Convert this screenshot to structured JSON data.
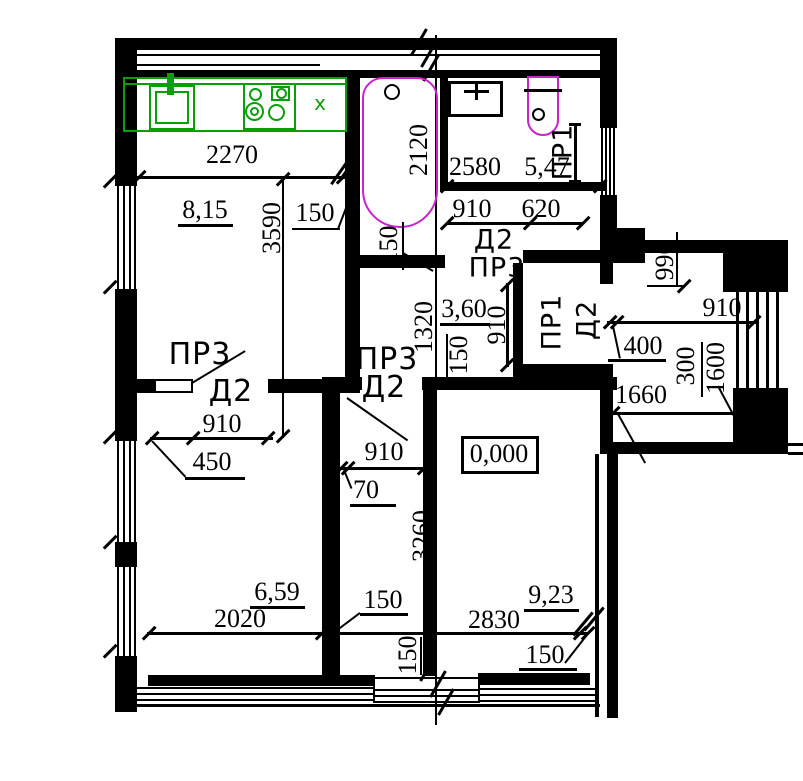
{
  "drawing": {
    "type": "apartment floor plan",
    "level_mark": "0,000"
  },
  "colors": {
    "walls": "#000000",
    "kitchen_fixtures": "#0a9e0a",
    "plumbing_fixtures": "#cc22cc"
  },
  "labels": {
    "kitchen_width": "2270",
    "kitchen_area": "8,15",
    "kitchen_depth": "3590",
    "kitchen_wall150": "150",
    "kitchen_x": "x",
    "tub_len": "2120",
    "tub_150": "150",
    "bath_width": "2580",
    "bath_area": "5,47",
    "bath_window": "ПР1",
    "hall_door910": "910",
    "hall_620": "620",
    "hall_d2": "Д2",
    "hall_pr3": "ПР3",
    "entry_990": "990",
    "entry_910": "910",
    "entry_400": "400",
    "entry_300": "300",
    "entry_1600": "1600",
    "entry_1660": "1660",
    "closet_910": "910",
    "closet_pr1": "ПР1",
    "closet_d2": "Д2",
    "hallway_area": "3,60",
    "hallway_1320": "1320",
    "hallway_150": "150",
    "center_pr3": "ПР3",
    "center_d2": "Д2",
    "center_910": "910",
    "center_70": "70",
    "left_pr3": "ПР3",
    "left_d2": "Д2",
    "left_910": "910",
    "left_450": "450",
    "level": "0,000",
    "corr_3260": "3260",
    "left_area": "6,59",
    "left_2020": "2020",
    "left_150": "150",
    "right_area": "9,23",
    "right_2830": "2830",
    "right_150": "150",
    "balcony_150": "150"
  }
}
